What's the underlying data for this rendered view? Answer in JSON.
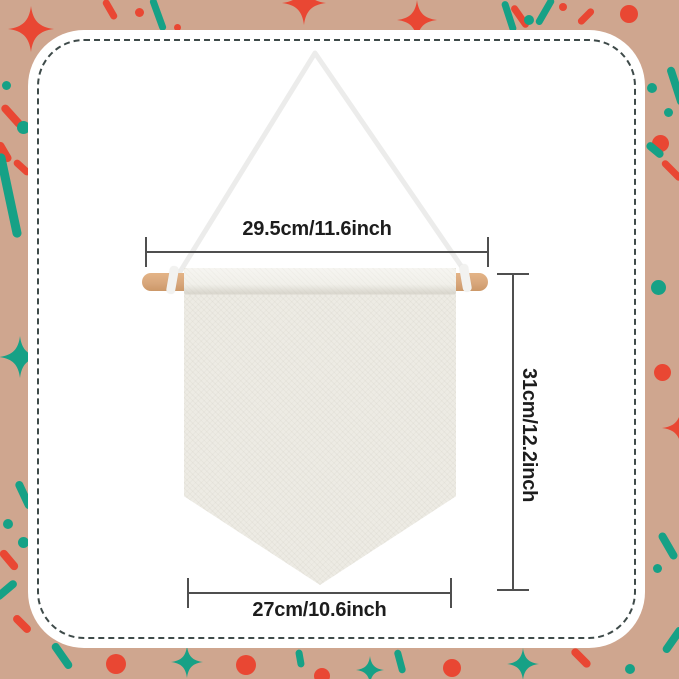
{
  "dimensions": {
    "rod_width_label": "29.5cm/11.6inch",
    "height_label": "31cm/12.2inch",
    "banner_width_label": "27cm/10.6inch"
  },
  "colors": {
    "background": "#cfa68f",
    "confetti_red": "#e94733",
    "confetti_teal": "#16a186",
    "panel": "#ffffff",
    "dash_border": "#3e4a49",
    "dimension_line": "#4f4f4f",
    "label_text": "#1d1d1d",
    "wood": "#d8a77c",
    "rope": "#ececeb",
    "canvas": "#edebe4"
  },
  "decorations": {
    "items": [
      {
        "shape": "sparkle",
        "color": "red",
        "x": 31,
        "y": 29,
        "w": 46,
        "h": 46
      },
      {
        "shape": "stick",
        "color": "red",
        "x": 110,
        "y": 9,
        "l": 22,
        "t": 7,
        "rot": 60
      },
      {
        "shape": "dot",
        "color": "red",
        "x": 139,
        "y": 12,
        "d": 9
      },
      {
        "shape": "stick",
        "color": "teal",
        "x": 158,
        "y": 14,
        "l": 34,
        "t": 7,
        "rot": 70
      },
      {
        "shape": "dot",
        "color": "red",
        "x": 177,
        "y": 27,
        "d": 7
      },
      {
        "shape": "sparkle",
        "color": "red",
        "x": 304,
        "y": 3,
        "w": 44,
        "h": 50
      },
      {
        "shape": "sparkle",
        "color": "red",
        "x": 417,
        "y": 20,
        "w": 40,
        "h": 44
      },
      {
        "shape": "stick",
        "color": "teal",
        "x": 509,
        "y": 16,
        "l": 32,
        "t": 7,
        "rot": 72
      },
      {
        "shape": "stick",
        "color": "red",
        "x": 520,
        "y": 16,
        "l": 26,
        "t": 7,
        "rot": 55
      },
      {
        "shape": "dot",
        "color": "teal",
        "x": 529,
        "y": 20,
        "d": 10
      },
      {
        "shape": "stick",
        "color": "teal",
        "x": 545,
        "y": 11,
        "l": 30,
        "t": 7,
        "rot": -60
      },
      {
        "shape": "dot",
        "color": "red",
        "x": 563,
        "y": 7,
        "d": 8
      },
      {
        "shape": "stick",
        "color": "red",
        "x": 586,
        "y": 16,
        "l": 20,
        "t": 7,
        "rot": -45
      },
      {
        "shape": "dot",
        "color": "red",
        "x": 629,
        "y": 14,
        "d": 18
      },
      {
        "shape": "dot",
        "color": "teal",
        "x": 652,
        "y": 88,
        "d": 10
      },
      {
        "shape": "dot",
        "color": "teal",
        "x": 668,
        "y": 112,
        "d": 9
      },
      {
        "shape": "stick",
        "color": "teal",
        "x": 676,
        "y": 86,
        "l": 40,
        "t": 8,
        "rot": 72
      },
      {
        "shape": "dot",
        "color": "red",
        "x": 660,
        "y": 143,
        "d": 17
      },
      {
        "shape": "stick",
        "color": "teal",
        "x": 655,
        "y": 150,
        "l": 20,
        "t": 8,
        "rot": 40
      },
      {
        "shape": "stick",
        "color": "red",
        "x": 672,
        "y": 170,
        "l": 26,
        "t": 7,
        "rot": 45
      },
      {
        "shape": "dot",
        "color": "teal",
        "x": 640,
        "y": 193,
        "d": 7
      },
      {
        "shape": "dot",
        "color": "teal",
        "x": 611,
        "y": 176,
        "d": 6
      },
      {
        "shape": "dot",
        "color": "teal",
        "x": 658,
        "y": 287,
        "d": 15
      },
      {
        "shape": "dot",
        "color": "red",
        "x": 662,
        "y": 372,
        "d": 17
      },
      {
        "shape": "sparkle",
        "color": "red",
        "x": 681,
        "y": 428,
        "w": 38,
        "h": 42
      },
      {
        "shape": "stick",
        "color": "teal",
        "x": 668,
        "y": 546,
        "l": 30,
        "t": 8,
        "rot": 60
      },
      {
        "shape": "dot",
        "color": "teal",
        "x": 657,
        "y": 568,
        "d": 9
      },
      {
        "shape": "dot",
        "color": "teal",
        "x": 6,
        "y": 85,
        "d": 9
      },
      {
        "shape": "stick",
        "color": "red",
        "x": 12,
        "y": 116,
        "l": 28,
        "t": 8,
        "rot": 48
      },
      {
        "shape": "dot",
        "color": "teal",
        "x": 23,
        "y": 127,
        "d": 13
      },
      {
        "shape": "stick",
        "color": "red",
        "x": 4,
        "y": 152,
        "l": 22,
        "t": 8,
        "rot": 60
      },
      {
        "shape": "stick",
        "color": "teal",
        "x": 9,
        "y": 195,
        "l": 86,
        "t": 9,
        "rot": 78
      },
      {
        "shape": "stick",
        "color": "red",
        "x": 22,
        "y": 167,
        "l": 20,
        "t": 7,
        "rot": 42
      },
      {
        "shape": "sparkle",
        "color": "teal",
        "x": 20,
        "y": 357,
        "w": 42,
        "h": 46
      },
      {
        "shape": "stick",
        "color": "teal",
        "x": 24,
        "y": 495,
        "l": 30,
        "t": 8,
        "rot": 65
      },
      {
        "shape": "dot",
        "color": "teal",
        "x": 8,
        "y": 524,
        "d": 10
      },
      {
        "shape": "dot",
        "color": "teal",
        "x": 23,
        "y": 542,
        "d": 11
      },
      {
        "shape": "stick",
        "color": "red",
        "x": 9,
        "y": 560,
        "l": 24,
        "t": 8,
        "rot": 50
      },
      {
        "shape": "dot",
        "color": "teal",
        "x": 37,
        "y": 598,
        "d": 8
      },
      {
        "shape": "stick",
        "color": "teal",
        "x": 6,
        "y": 590,
        "l": 26,
        "t": 8,
        "rot": -40
      },
      {
        "shape": "stick",
        "color": "red",
        "x": 22,
        "y": 624,
        "l": 22,
        "t": 8,
        "rot": 45
      },
      {
        "shape": "stick",
        "color": "teal",
        "x": 62,
        "y": 656,
        "l": 30,
        "t": 8,
        "rot": 55
      },
      {
        "shape": "dot",
        "color": "red",
        "x": 116,
        "y": 664,
        "d": 20
      },
      {
        "shape": "sparkle",
        "color": "teal",
        "x": 187,
        "y": 662,
        "w": 32,
        "h": 52
      },
      {
        "shape": "dot",
        "color": "red",
        "x": 246,
        "y": 665,
        "d": 20
      },
      {
        "shape": "stick",
        "color": "teal",
        "x": 300,
        "y": 658,
        "l": 18,
        "t": 7,
        "rot": 80
      },
      {
        "shape": "dot",
        "color": "red",
        "x": 322,
        "y": 676,
        "d": 16
      },
      {
        "shape": "sparkle",
        "color": "teal",
        "x": 370,
        "y": 670,
        "w": 28,
        "h": 46
      },
      {
        "shape": "stick",
        "color": "teal",
        "x": 400,
        "y": 661,
        "l": 24,
        "t": 7,
        "rot": 75
      },
      {
        "shape": "dot",
        "color": "red",
        "x": 452,
        "y": 668,
        "d": 18
      },
      {
        "shape": "sparkle",
        "color": "teal",
        "x": 523,
        "y": 664,
        "w": 32,
        "h": 52
      },
      {
        "shape": "stick",
        "color": "red",
        "x": 581,
        "y": 658,
        "l": 24,
        "t": 8,
        "rot": 45
      },
      {
        "shape": "dot",
        "color": "teal",
        "x": 630,
        "y": 669,
        "d": 10
      },
      {
        "shape": "stick",
        "color": "teal",
        "x": 673,
        "y": 640,
        "l": 30,
        "t": 8,
        "rot": -55
      }
    ]
  }
}
